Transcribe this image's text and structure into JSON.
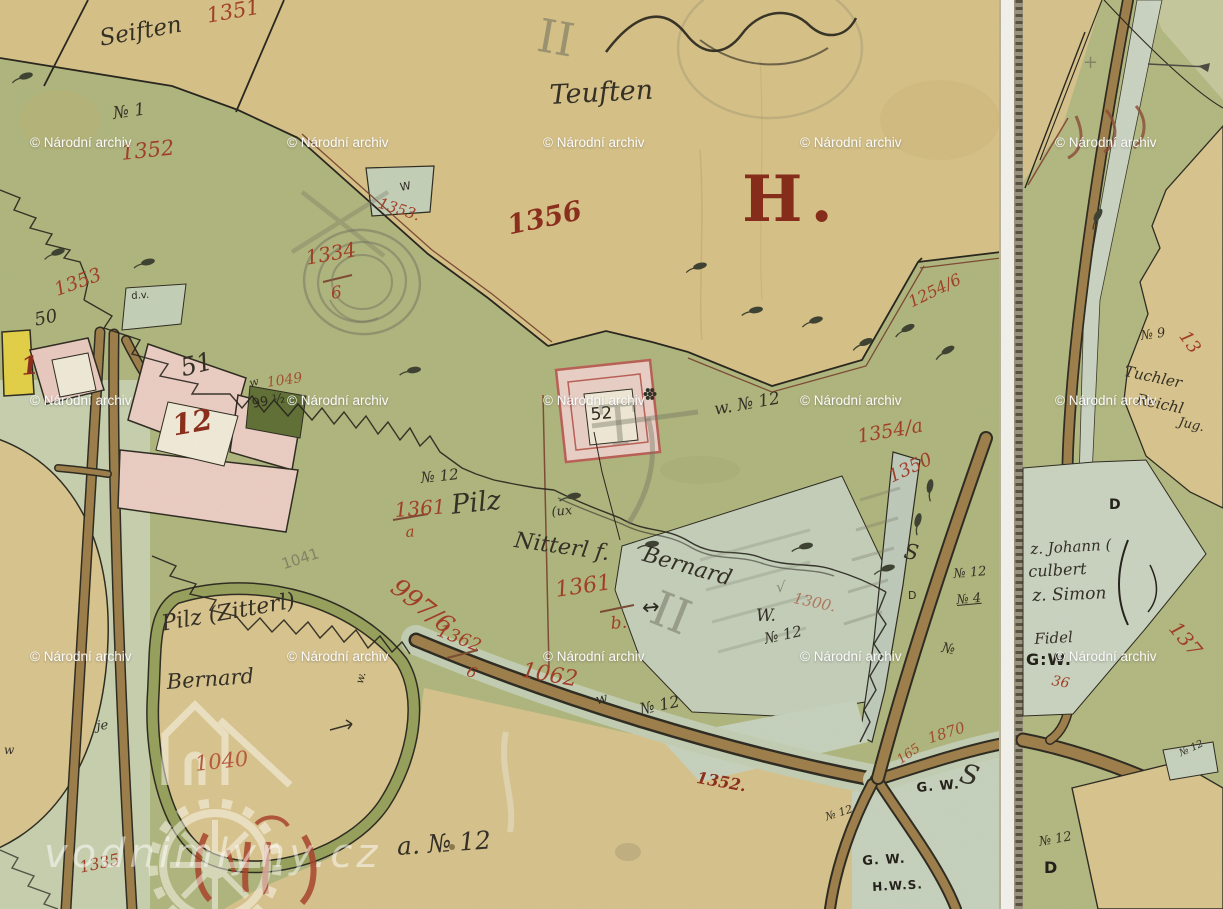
{
  "section_letter": "H.",
  "logo": {
    "text": "vodnimlyny.cz"
  },
  "archive_watermark": {
    "text": "© Národní archiv",
    "grid_x": [
      30,
      287,
      543,
      800,
      1055
    ],
    "grid_y": [
      136,
      394,
      650
    ]
  },
  "ink_colors": {
    "red_ink": "#a03f27",
    "dark_red_ink": "#8a2f1d",
    "black_ink": "#2d2a20",
    "pencil": "#686a58"
  },
  "labels": [
    {
      "t": "1351",
      "x": 205,
      "y": 6,
      "s": 21,
      "r": -10,
      "c": "red"
    },
    {
      "t": "Seiften",
      "x": 98,
      "y": 28,
      "s": 23,
      "r": -10,
      "c": "script"
    },
    {
      "t": "№ 1",
      "x": 112,
      "y": 106,
      "s": 17,
      "r": -8,
      "c": "script"
    },
    {
      "t": "1352",
      "x": 120,
      "y": 143,
      "s": 21,
      "r": -6,
      "c": "red"
    },
    {
      "t": "1353",
      "x": 52,
      "y": 282,
      "s": 19,
      "r": -20,
      "c": "red"
    },
    {
      "t": "1353.",
      "x": 381,
      "y": 196,
      "s": 15,
      "r": 18,
      "c": "red"
    },
    {
      "t": "W",
      "x": 399,
      "y": 182,
      "s": 11,
      "r": -10,
      "c": "black"
    },
    {
      "t": "1334",
      "x": 304,
      "y": 248,
      "s": 20,
      "r": -10,
      "c": "red"
    },
    {
      "t": "6",
      "x": 330,
      "y": 286,
      "s": 17,
      "r": -8,
      "c": "red"
    },
    {
      "t": "d.v.",
      "x": 131,
      "y": 292,
      "s": 10,
      "r": -4,
      "c": "black"
    },
    {
      "t": "1356",
      "x": 505,
      "y": 213,
      "s": 27,
      "r": -12,
      "c": "darkred"
    },
    {
      "t": "II",
      "x": 542,
      "y": 12,
      "s": 46,
      "r": 10,
      "c": "pencilserif",
      "o": 0.55
    },
    {
      "t": "Teuften",
      "x": 549,
      "y": 82,
      "s": 27,
      "r": -3,
      "c": "script"
    },
    {
      "t": "1254/6",
      "x": 906,
      "y": 296,
      "s": 16,
      "r": -26,
      "c": "red"
    },
    {
      "t": "50",
      "x": 33,
      "y": 312,
      "s": 18,
      "r": -12,
      "c": "script"
    },
    {
      "t": "1",
      "x": 20,
      "y": 354,
      "s": 25,
      "r": -5,
      "c": "darkred"
    },
    {
      "t": "51",
      "x": 178,
      "y": 356,
      "s": 25,
      "r": -14,
      "c": "script"
    },
    {
      "t": "12",
      "x": 170,
      "y": 412,
      "s": 29,
      "r": -10,
      "c": "darkred"
    },
    {
      "t": "1049",
      "x": 266,
      "y": 376,
      "s": 14,
      "r": -8,
      "c": "red",
      "o": 0.85
    },
    {
      "t": "99 ½",
      "x": 251,
      "y": 398,
      "s": 13,
      "r": -10,
      "c": "black"
    },
    {
      "t": "52",
      "x": 590,
      "y": 407,
      "s": 17,
      "r": -5,
      "c": "black"
    },
    {
      "t": "w. № 12",
      "x": 713,
      "y": 402,
      "s": 17,
      "r": -10,
      "c": "script"
    },
    {
      "t": "1354/a",
      "x": 856,
      "y": 428,
      "s": 19,
      "r": -10,
      "c": "red"
    },
    {
      "t": "1350",
      "x": 886,
      "y": 470,
      "s": 18,
      "r": -25,
      "c": "red"
    },
    {
      "t": "№ 12",
      "x": 420,
      "y": 471,
      "s": 15,
      "r": -6,
      "c": "script"
    },
    {
      "t": "1361",
      "x": 394,
      "y": 500,
      "s": 20,
      "r": -4,
      "c": "red"
    },
    {
      "t": "a",
      "x": 405,
      "y": 525,
      "s": 15,
      "r": -4,
      "c": "red"
    },
    {
      "t": "Pilz",
      "x": 450,
      "y": 492,
      "s": 27,
      "r": -6,
      "c": "script"
    },
    {
      "t": "(ux",
      "x": 551,
      "y": 506,
      "s": 13,
      "r": -5,
      "c": "script"
    },
    {
      "t": "Nitterl f.",
      "x": 516,
      "y": 530,
      "s": 22,
      "r": 8,
      "c": "script"
    },
    {
      "t": "Bernard",
      "x": 646,
      "y": 544,
      "s": 22,
      "r": 16,
      "c": "script"
    },
    {
      "t": "√",
      "x": 776,
      "y": 580,
      "s": 15,
      "r": 0,
      "c": "pencil"
    },
    {
      "t": "1300.",
      "x": 795,
      "y": 591,
      "s": 15,
      "r": 12,
      "c": "red",
      "o": 0.6
    },
    {
      "t": "1361",
      "x": 554,
      "y": 580,
      "s": 22,
      "r": -8,
      "c": "red"
    },
    {
      "t": "b.",
      "x": 610,
      "y": 616,
      "s": 17,
      "r": -5,
      "c": "red"
    },
    {
      "t": "↔",
      "x": 641,
      "y": 598,
      "s": 21,
      "r": -6,
      "c": "black"
    },
    {
      "t": "W.",
      "x": 756,
      "y": 608,
      "s": 17,
      "r": 0,
      "c": "script"
    },
    {
      "t": "№ 12",
      "x": 763,
      "y": 632,
      "s": 15,
      "r": -12,
      "c": "script"
    },
    {
      "t": "997/6",
      "x": 402,
      "y": 574,
      "s": 25,
      "r": 38,
      "c": "red"
    },
    {
      "t": "1362",
      "x": 441,
      "y": 622,
      "s": 18,
      "r": 22,
      "c": "red"
    },
    {
      "t": "6",
      "x": 470,
      "y": 664,
      "s": 15,
      "r": 22,
      "c": "red"
    },
    {
      "t": "1062",
      "x": 524,
      "y": 660,
      "s": 22,
      "r": 10,
      "c": "red"
    },
    {
      "t": "1041",
      "x": 280,
      "y": 558,
      "s": 15,
      "r": -18,
      "c": "pencil"
    },
    {
      "t": "Pilz (Zitterl)",
      "x": 160,
      "y": 614,
      "s": 22,
      "r": -10,
      "c": "script"
    },
    {
      "t": "Bernard",
      "x": 166,
      "y": 672,
      "s": 21,
      "r": -4,
      "c": "script"
    },
    {
      "t": "1040",
      "x": 194,
      "y": 754,
      "s": 21,
      "r": -6,
      "c": "redlight"
    },
    {
      "t": "1335",
      "x": 78,
      "y": 860,
      "s": 16,
      "r": -12,
      "c": "red"
    },
    {
      "t": "a. № 12",
      "x": 396,
      "y": 834,
      "s": 25,
      "r": -4,
      "c": "script"
    },
    {
      "t": "w",
      "x": 594,
      "y": 694,
      "s": 14,
      "r": -15,
      "c": "script"
    },
    {
      "t": "№ 12",
      "x": 638,
      "y": 702,
      "s": 16,
      "r": -12,
      "c": "script"
    },
    {
      "t": "1352.",
      "x": 698,
      "y": 770,
      "s": 16,
      "r": 10,
      "c": "darkred"
    },
    {
      "t": "№ 12",
      "x": 824,
      "y": 812,
      "s": 11,
      "r": -18,
      "c": "script"
    },
    {
      "t": "G. W.",
      "x": 916,
      "y": 782,
      "s": 13,
      "r": -5,
      "c": "blackb"
    },
    {
      "t": "S",
      "x": 964,
      "y": 760,
      "s": 27,
      "r": 15,
      "c": "script"
    },
    {
      "t": "1870",
      "x": 926,
      "y": 732,
      "s": 15,
      "r": -18,
      "c": "red",
      "o": 0.9
    },
    {
      "t": "165",
      "x": 895,
      "y": 756,
      "s": 13,
      "r": -35,
      "c": "red",
      "o": 0.9
    },
    {
      "t": "G. W.",
      "x": 862,
      "y": 855,
      "s": 13,
      "r": -3,
      "c": "blackb"
    },
    {
      "t": "H.W.S.",
      "x": 872,
      "y": 881,
      "s": 12,
      "r": -3,
      "c": "blackb"
    },
    {
      "t": "№ 12",
      "x": 953,
      "y": 568,
      "s": 13,
      "r": -5,
      "c": "script"
    },
    {
      "t": "№ 4",
      "x": 956,
      "y": 594,
      "s": 13,
      "r": -5,
      "c": "script u"
    },
    {
      "t": "S",
      "x": 906,
      "y": 541,
      "s": 21,
      "r": 10,
      "c": "script"
    },
    {
      "t": "D",
      "x": 908,
      "y": 590,
      "s": 11,
      "r": 0,
      "c": "black"
    },
    {
      "t": "№",
      "x": 943,
      "y": 641,
      "s": 14,
      "r": 10,
      "c": "script"
    },
    {
      "t": "w.",
      "x": 354,
      "y": 682,
      "s": 11,
      "r": -75,
      "c": "script"
    },
    {
      "t": "je",
      "x": 96,
      "y": 720,
      "s": 13,
      "r": -5,
      "c": "script"
    },
    {
      "t": "w",
      "x": 4,
      "y": 744,
      "s": 12,
      "r": 0,
      "c": "script"
    },
    {
      "t": "w",
      "x": 248,
      "y": 378,
      "s": 11,
      "r": -15,
      "c": "script"
    },
    {
      "t": "T",
      "x": 598,
      "y": 400,
      "s": 56,
      "r": -5,
      "c": "pencilserif",
      "o": 0.4
    },
    {
      "t": "II",
      "x": 662,
      "y": 584,
      "s": 48,
      "r": 22,
      "c": "pencilserif",
      "o": 0.5
    },
    {
      "t": "+",
      "x": 1083,
      "y": 54,
      "s": 18,
      "r": 0,
      "c": "pencil"
    },
    {
      "t": "№ 9",
      "x": 1140,
      "y": 330,
      "s": 13,
      "r": -8,
      "c": "script"
    },
    {
      "t": "Tuchler",
      "x": 1126,
      "y": 364,
      "s": 15,
      "r": 12,
      "c": "script"
    },
    {
      "t": "Reichl",
      "x": 1138,
      "y": 392,
      "s": 15,
      "r": 12,
      "c": "script"
    },
    {
      "t": "Jug.",
      "x": 1180,
      "y": 416,
      "s": 13,
      "r": 12,
      "c": "script"
    },
    {
      "t": "z. Johann (",
      "x": 1030,
      "y": 542,
      "s": 15,
      "r": -3,
      "c": "script"
    },
    {
      "t": "culbert",
      "x": 1028,
      "y": 564,
      "s": 16,
      "r": -3,
      "c": "script"
    },
    {
      "t": "z. Simon",
      "x": 1032,
      "y": 588,
      "s": 17,
      "r": -2,
      "c": "script"
    },
    {
      "t": "Fidel",
      "x": 1034,
      "y": 632,
      "s": 15,
      "r": -3,
      "c": "script"
    },
    {
      "t": "G:W.",
      "x": 1026,
      "y": 652,
      "s": 16,
      "r": 0,
      "c": "blackb"
    },
    {
      "t": "36",
      "x": 1053,
      "y": 674,
      "s": 14,
      "r": 10,
      "c": "red"
    },
    {
      "t": "13",
      "x": 1190,
      "y": 328,
      "s": 18,
      "r": 55,
      "c": "red"
    },
    {
      "t": "137",
      "x": 1181,
      "y": 618,
      "s": 20,
      "r": 50,
      "c": "red"
    },
    {
      "t": "D",
      "x": 1109,
      "y": 498,
      "s": 14,
      "r": 0,
      "c": "blackb"
    },
    {
      "t": "D",
      "x": 1044,
      "y": 860,
      "s": 16,
      "r": 0,
      "c": "blackb"
    },
    {
      "t": "№ 12",
      "x": 1038,
      "y": 836,
      "s": 13,
      "r": -10,
      "c": "script"
    },
    {
      "t": "№ 12",
      "x": 1178,
      "y": 750,
      "s": 10,
      "r": -25,
      "c": "script"
    }
  ]
}
